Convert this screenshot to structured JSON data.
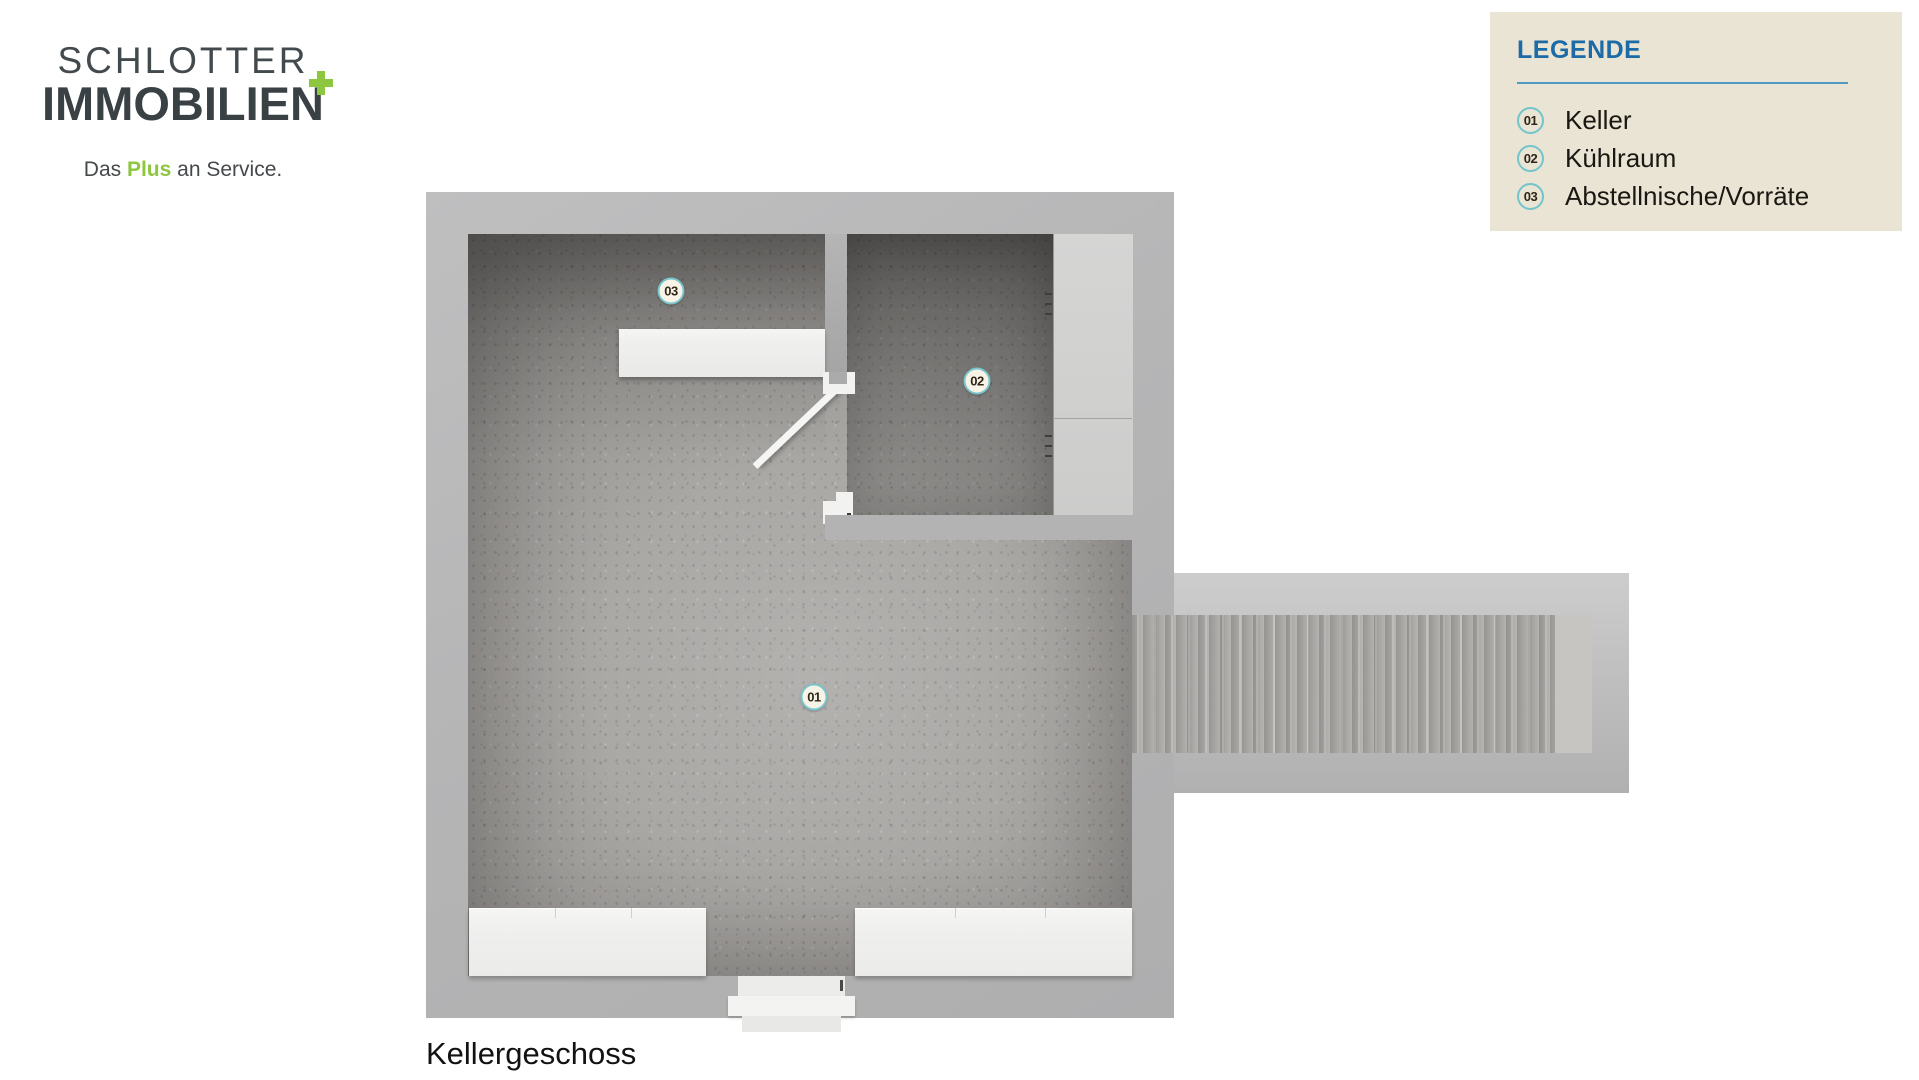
{
  "logo": {
    "line1": "SCHLOTTER",
    "line2": "IMMOBILIEN",
    "tagline": {
      "prefix": "Das ",
      "highlight": "Plus",
      "suffix": " an Service."
    },
    "brand_green": "#8dc63f",
    "brand_dark": "#3a4145"
  },
  "legend": {
    "title": "LEGENDE",
    "background": "#e9e4d3",
    "title_color": "#1d6ba6",
    "divider_color": "#4e9ac2",
    "circle_ring_color": "#72c5cb",
    "items": [
      {
        "number": "01",
        "label": "Keller"
      },
      {
        "number": "02",
        "label": "Kühlraum"
      },
      {
        "number": "03",
        "label": "Abstellnische/Vorräte"
      }
    ]
  },
  "plan": {
    "caption": "Kellergeschoss",
    "markers": [
      {
        "number": "01",
        "x": 814,
        "y": 697
      },
      {
        "number": "02",
        "x": 977,
        "y": 381
      },
      {
        "number": "03",
        "x": 671,
        "y": 291
      }
    ],
    "colors": {
      "wall": "#b5b5b6",
      "floor": "#a7a5a2",
      "room_floor_dark": "#86847f",
      "furniture_white": "#f0f0ef",
      "shelf_gray": "#d2d2d1",
      "marker_fill": "#f7f3e6",
      "marker_ring": "#7ac6cc"
    }
  }
}
